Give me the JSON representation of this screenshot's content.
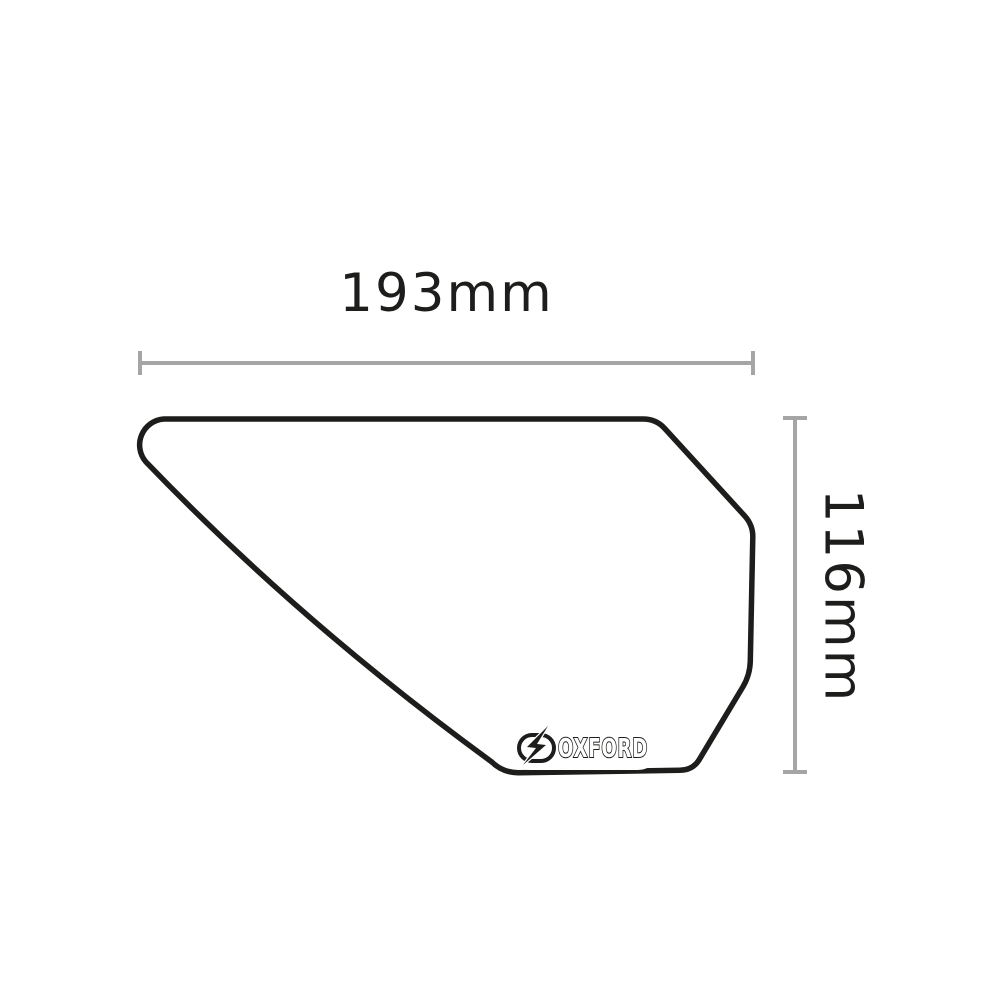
{
  "diagram": {
    "width_label": "193mm",
    "height_label": "116mm"
  },
  "product": {
    "brand": "OXFORD",
    "item": "tank pad outline drawing",
    "texture": "diamond rosette (rhombille) grip pattern"
  },
  "colors": {
    "ink": "#1d1d1b",
    "dimension_line": "#a5a5a5",
    "pattern_line": "#3c3c3c",
    "background": "#ffffff"
  }
}
